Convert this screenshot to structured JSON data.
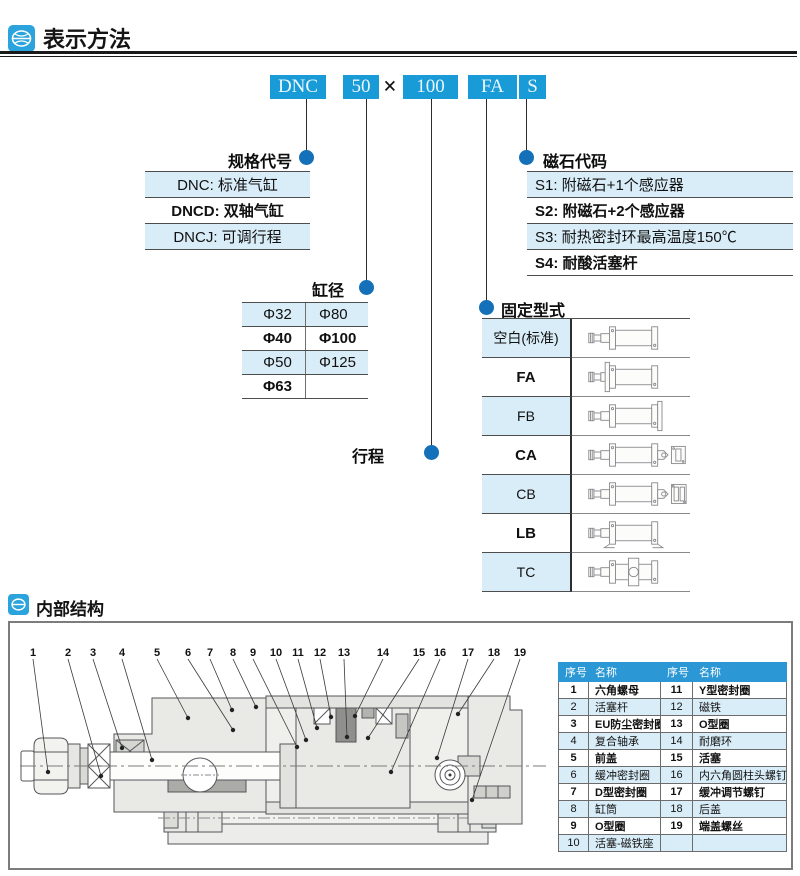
{
  "header": {
    "title": "表示方法",
    "icon": "brand-globe-icon"
  },
  "model_code": {
    "segments": [
      {
        "text": "DNC",
        "kind": "box"
      },
      {
        "text": "50",
        "kind": "box"
      },
      {
        "text": "×",
        "kind": "sep"
      },
      {
        "text": "100",
        "kind": "box"
      },
      {
        "text": "FA",
        "kind": "box"
      },
      {
        "text": "S",
        "kind": "box"
      }
    ]
  },
  "spec_code": {
    "label": "规格代号",
    "rows": [
      {
        "text": "DNC: 标准气缸",
        "bold": false
      },
      {
        "text": "DNCD: 双轴气缸",
        "bold": true
      },
      {
        "text": "DNCJ: 可调行程",
        "bold": false
      }
    ]
  },
  "bore": {
    "label": "缸径",
    "rows": [
      {
        "c1": "Φ32",
        "c2": "Φ80",
        "bold": false
      },
      {
        "c1": "Φ40",
        "c2": "Φ100",
        "bold": true
      },
      {
        "c1": "Φ50",
        "c2": "Φ125",
        "bold": false
      },
      {
        "c1": "Φ63",
        "c2": "",
        "bold": true
      }
    ]
  },
  "stroke": {
    "label": "行程"
  },
  "magnet_code": {
    "label": "磁石代码",
    "rows": [
      {
        "text": "S1: 附磁石+1个感应器",
        "bold": false
      },
      {
        "text": "S2: 附磁石+2个感应器",
        "bold": true
      },
      {
        "text": "S3: 耐热密封环最高温度150℃",
        "bold": false
      },
      {
        "text": "S4: 耐酸活塞杆",
        "bold": true
      }
    ]
  },
  "mounting": {
    "label": "固定型式",
    "rows": [
      {
        "label": "空白(标准)",
        "diagram": "cylinder-basic-icon",
        "bold": false
      },
      {
        "label": "FA",
        "diagram": "cylinder-front-flange-icon",
        "bold": true
      },
      {
        "label": "FB",
        "diagram": "cylinder-rear-flange-icon",
        "bold": false
      },
      {
        "label": "CA",
        "diagram": "cylinder-rear-clevis-icon",
        "bold": true
      },
      {
        "label": "CB",
        "diagram": "cylinder-double-clevis-icon",
        "bold": false
      },
      {
        "label": "LB",
        "diagram": "cylinder-foot-mount-icon",
        "bold": true
      },
      {
        "label": "TC",
        "diagram": "cylinder-trunnion-icon",
        "bold": false
      }
    ]
  },
  "internal": {
    "title": "内部结构",
    "callouts": [
      "1",
      "2",
      "3",
      "4",
      "5",
      "6",
      "7",
      "8",
      "9",
      "10",
      "11",
      "12",
      "13",
      "14",
      "15",
      "16",
      "17",
      "18",
      "19"
    ],
    "parts_table": {
      "headers": [
        "序号",
        "名称",
        "序号",
        "名称"
      ],
      "rows": [
        {
          "cells": [
            "1",
            "六角螺母",
            "11",
            "Y型密封圈"
          ],
          "bold": true
        },
        {
          "cells": [
            "2",
            "活塞杆",
            "12",
            "磁铁"
          ],
          "bold": false
        },
        {
          "cells": [
            "3",
            "EU防尘密封圈",
            "13",
            "O型圈"
          ],
          "bold": true
        },
        {
          "cells": [
            "4",
            "复合轴承",
            "14",
            "耐磨环"
          ],
          "bold": false
        },
        {
          "cells": [
            "5",
            "前盖",
            "15",
            "活塞"
          ],
          "bold": true
        },
        {
          "cells": [
            "6",
            "缓冲密封圈",
            "16",
            "内六角圆柱头螺钉"
          ],
          "bold": false
        },
        {
          "cells": [
            "7",
            "D型密封圈",
            "17",
            "缓冲调节螺钉"
          ],
          "bold": true
        },
        {
          "cells": [
            "8",
            "缸筒",
            "18",
            "后盖"
          ],
          "bold": false
        },
        {
          "cells": [
            "9",
            "O型圈",
            "19",
            "端盖螺丝"
          ],
          "bold": true
        },
        {
          "cells": [
            "10",
            "活塞-磁铁座",
            "",
            ""
          ],
          "bold": false
        }
      ]
    }
  },
  "colors": {
    "accent_blue": "#189bd7",
    "dot_blue": "#1470b8",
    "row_blue": "#d9edf8",
    "table_header_blue": "#2b97d4"
  }
}
